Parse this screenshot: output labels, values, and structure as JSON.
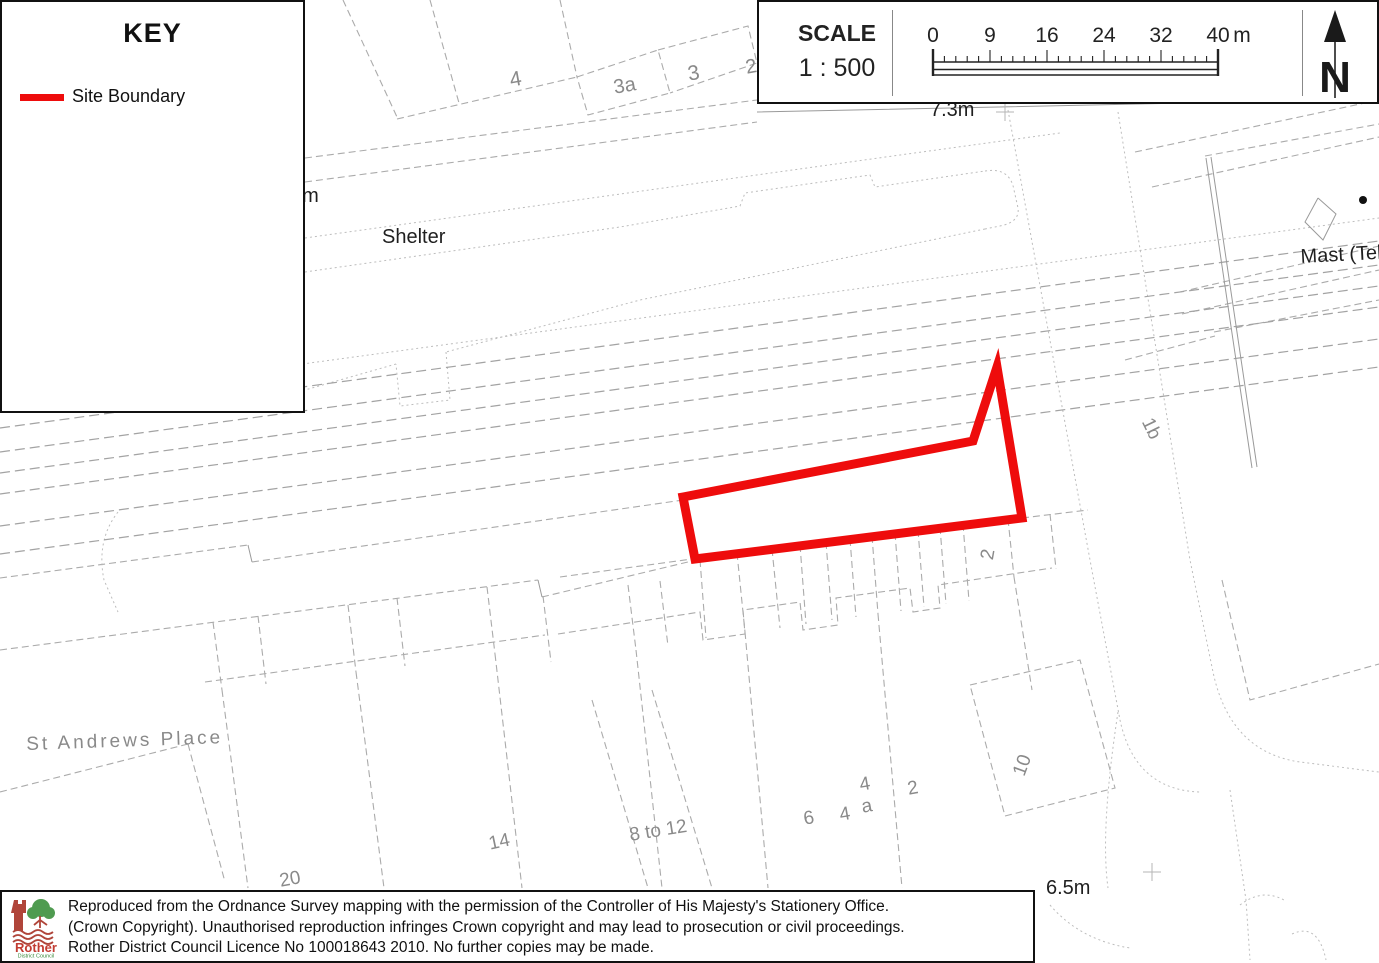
{
  "page": {
    "width": 1379,
    "height": 963,
    "background": "#ffffff"
  },
  "colors": {
    "boundary": "#ee0c0c",
    "map_line": "#ababab",
    "label_gray": "#8a8a8a",
    "label_dark": "#1f1f1f",
    "panel_border": "#111111",
    "logo_red": "#b0453a",
    "logo_text_red": "#c23b31",
    "logo_green": "#4f9b50",
    "logo_text_green": "#3a8a3a"
  },
  "key_panel": {
    "title": "KEY",
    "items": [
      {
        "label": "Site Boundary",
        "swatch_color": "#ee0c0c"
      }
    ]
  },
  "scale_panel": {
    "label": "SCALE",
    "ratio": "1 : 500",
    "ticks": [
      "0",
      "9",
      "16",
      "24",
      "32",
      "40"
    ],
    "unit": "m",
    "north_label": "N"
  },
  "map": {
    "labels": [
      {
        "t": "4",
        "x": 508,
        "y": 70,
        "r": -10,
        "c": "g",
        "s": 21
      },
      {
        "t": "3a",
        "x": 612,
        "y": 78,
        "r": -10,
        "c": "g",
        "s": 20
      },
      {
        "t": "3",
        "x": 686,
        "y": 64,
        "r": -10,
        "c": "g",
        "s": 21
      },
      {
        "t": "2",
        "x": 744,
        "y": 58,
        "r": -10,
        "c": "g",
        "s": 20
      },
      {
        "t": "7.3m",
        "x": 930,
        "y": 100,
        "r": 0,
        "c": "d",
        "s": 20
      },
      {
        "t": "4m",
        "x": 291,
        "y": 186,
        "r": 0,
        "c": "d",
        "s": 20
      },
      {
        "t": "Shelter",
        "x": 382,
        "y": 227,
        "r": 0,
        "c": "d",
        "s": 20
      },
      {
        "t": "Mast (Tele",
        "x": 1300,
        "y": 247,
        "r": -3,
        "c": "d",
        "s": 20
      },
      {
        "t": "1b",
        "x": 1155,
        "y": 415,
        "r": 64,
        "c": "g",
        "s": 19
      },
      {
        "t": "2",
        "x": 978,
        "y": 558,
        "r": -80,
        "c": "g",
        "s": 19
      },
      {
        "t": "St Andrews Place",
        "x": 26,
        "y": 735,
        "r": -2,
        "c": "g",
        "s": 19,
        "ls": 3
      },
      {
        "t": "20",
        "x": 278,
        "y": 872,
        "r": -10,
        "c": "g",
        "s": 19
      },
      {
        "t": "14",
        "x": 487,
        "y": 835,
        "r": -12,
        "c": "g",
        "s": 19
      },
      {
        "t": "8 to 12",
        "x": 628,
        "y": 826,
        "r": -9,
        "c": "g",
        "s": 19
      },
      {
        "t": "6",
        "x": 802,
        "y": 810,
        "r": -10,
        "c": "g",
        "s": 19
      },
      {
        "t": "4",
        "x": 838,
        "y": 806,
        "r": -10,
        "c": "g",
        "s": 19
      },
      {
        "t": "4",
        "x": 858,
        "y": 776,
        "r": -10,
        "c": "g",
        "s": 19
      },
      {
        "t": "a",
        "x": 860,
        "y": 798,
        "r": -10,
        "c": "g",
        "s": 19
      },
      {
        "t": "2",
        "x": 906,
        "y": 780,
        "r": -10,
        "c": "g",
        "s": 19
      },
      {
        "t": "10",
        "x": 1010,
        "y": 772,
        "r": -70,
        "c": "g",
        "s": 19
      },
      {
        "t": "6.5m",
        "x": 1046,
        "y": 878,
        "r": 0,
        "c": "d",
        "s": 20
      }
    ],
    "markers": [
      {
        "type": "cross",
        "x": 1005,
        "y": 112
      },
      {
        "type": "cross",
        "x": 1152,
        "y": 872
      },
      {
        "type": "dot",
        "x": 1363,
        "y": 200
      }
    ]
  },
  "footer": {
    "logo": {
      "name": "Rother",
      "sub": "District Council"
    },
    "lines": [
      "Reproduced from the Ordnance Survey mapping with the permission of the Controller of His Majesty's Stationery Office.",
      "(Crown Copyright). Unauthorised reproduction infringes Crown copyright and may lead to prosecution or civil proceedings.",
      "Rother District Council Licence No 100018643 2010. No further copies may be made."
    ]
  }
}
